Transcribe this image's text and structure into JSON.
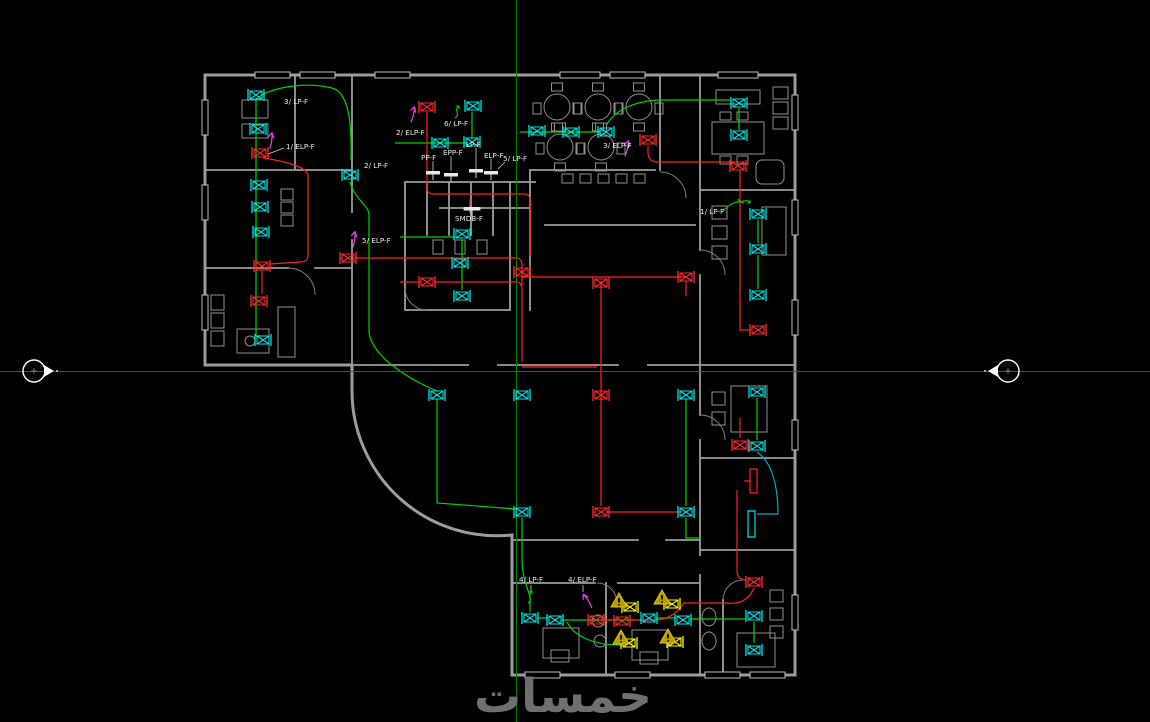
{
  "canvas": {
    "width": 1150,
    "height": 722
  },
  "crosshair": {
    "x": 516.5,
    "y": 371.5
  },
  "colors": {
    "background": "#000000",
    "wall": "#9c9c9c",
    "lighting_wire": "#00d400",
    "power_wire": "#ff1e1e",
    "teal_wire": "#00a8c8",
    "device_lighting": "#00e5e5",
    "device_power": "#ff2a2a",
    "device_emergency": "#ffff00",
    "warning_fill": "#b89a00",
    "warning_edge": "#e6c400",
    "arrow": "#e040e0",
    "construction_line": "#008200",
    "text": "#e8e8e8",
    "watermark": "#6f6f6f",
    "marker": "#ffffff"
  },
  "watermark": {
    "text": "خمسات"
  },
  "circuit_labels": [
    {
      "id": "lp3",
      "text": "3/ LP-F",
      "x": 284,
      "y": 104
    },
    {
      "id": "elp1",
      "text": "1/ ELP-F",
      "x": 286,
      "y": 149
    },
    {
      "id": "elp2",
      "text": "2/ ELP-F",
      "x": 396,
      "y": 135
    },
    {
      "id": "lp6",
      "text": "6/ LP-F",
      "x": 444,
      "y": 126
    },
    {
      "id": "ppf",
      "text": "PP-F",
      "x": 421,
      "y": 160
    },
    {
      "id": "eppf",
      "text": "EPP-F",
      "x": 443,
      "y": 155
    },
    {
      "id": "lpf",
      "text": "LP-F",
      "x": 466,
      "y": 147
    },
    {
      "id": "elpf",
      "text": "ELP-F",
      "x": 484,
      "y": 158
    },
    {
      "id": "lp5",
      "text": "5/ LP-F",
      "x": 503,
      "y": 161
    },
    {
      "id": "lp2",
      "text": "2/ LP-F",
      "x": 364,
      "y": 168
    },
    {
      "id": "smdb",
      "text": "SMDB-F",
      "x": 455,
      "y": 221
    },
    {
      "id": "elp5",
      "text": "5/ ELP-F",
      "x": 362,
      "y": 243
    },
    {
      "id": "elp3",
      "text": "3/ ELP-F",
      "x": 603,
      "y": 148
    },
    {
      "id": "lp1",
      "text": "1/ LP-F",
      "x": 700,
      "y": 214
    },
    {
      "id": "lp4",
      "text": "4/ LP-F",
      "x": 519,
      "y": 582
    },
    {
      "id": "elp4",
      "text": "4/ ELP-F",
      "x": 568,
      "y": 582
    }
  ],
  "panel_symbols": {
    "wall_units": [
      [
        433,
        173
      ],
      [
        451,
        175
      ],
      [
        476,
        171
      ],
      [
        491,
        173
      ]
    ],
    "smdb": [
      472,
      209
    ]
  },
  "devices": {
    "lighting": [
      [
        256,
        95
      ],
      [
        258,
        129
      ],
      [
        259,
        185
      ],
      [
        260,
        207
      ],
      [
        261,
        232
      ],
      [
        263,
        340
      ],
      [
        350,
        175
      ],
      [
        440,
        143
      ],
      [
        472,
        142
      ],
      [
        473,
        106
      ],
      [
        462,
        234
      ],
      [
        460,
        263
      ],
      [
        462,
        296
      ],
      [
        537,
        131
      ],
      [
        571,
        132
      ],
      [
        606,
        132
      ],
      [
        739,
        103
      ],
      [
        739,
        135
      ],
      [
        758,
        214
      ],
      [
        758,
        249
      ],
      [
        758,
        295
      ],
      [
        757,
        392
      ],
      [
        757,
        446
      ],
      [
        437,
        395
      ],
      [
        522,
        395
      ],
      [
        686,
        395
      ],
      [
        522,
        512
      ],
      [
        686,
        512
      ],
      [
        530,
        618
      ],
      [
        555,
        620
      ],
      [
        649,
        618
      ],
      [
        683,
        620
      ],
      [
        754,
        616
      ],
      [
        754,
        650
      ]
    ],
    "power": [
      [
        260,
        153
      ],
      [
        262,
        266
      ],
      [
        259,
        301
      ],
      [
        427,
        107
      ],
      [
        427,
        282
      ],
      [
        348,
        258
      ],
      [
        648,
        140
      ],
      [
        738,
        166
      ],
      [
        758,
        330
      ],
      [
        740,
        445
      ],
      [
        522,
        272
      ],
      [
        601,
        283
      ],
      [
        686,
        277
      ],
      [
        601,
        395
      ],
      [
        601,
        512
      ],
      [
        596,
        620
      ],
      [
        622,
        621
      ],
      [
        754,
        582
      ]
    ],
    "emergency": [
      [
        630,
        607
      ],
      [
        672,
        604
      ],
      [
        629,
        643
      ],
      [
        675,
        642
      ]
    ]
  },
  "warning_triangles": [
    [
      619,
      601
    ],
    [
      662,
      598
    ],
    [
      621,
      638
    ],
    [
      668,
      637
    ]
  ],
  "direction_arrows": [
    [
      271,
      138,
      -35
    ],
    [
      413,
      112,
      -30
    ],
    [
      627,
      146,
      -30
    ],
    [
      354,
      237,
      -35
    ],
    [
      586,
      599,
      -75
    ]
  ],
  "switch_marks": [
    [
      530,
      597,
      0
    ],
    [
      744,
      201,
      90
    ],
    [
      457,
      112,
      0
    ]
  ],
  "section_markers": {
    "left": {
      "cx": 34,
      "cy": 371,
      "dot_x": 57,
      "facing": "right"
    },
    "right": {
      "cx": 1008,
      "cy": 371,
      "dot_x": 985,
      "facing": "left"
    }
  }
}
